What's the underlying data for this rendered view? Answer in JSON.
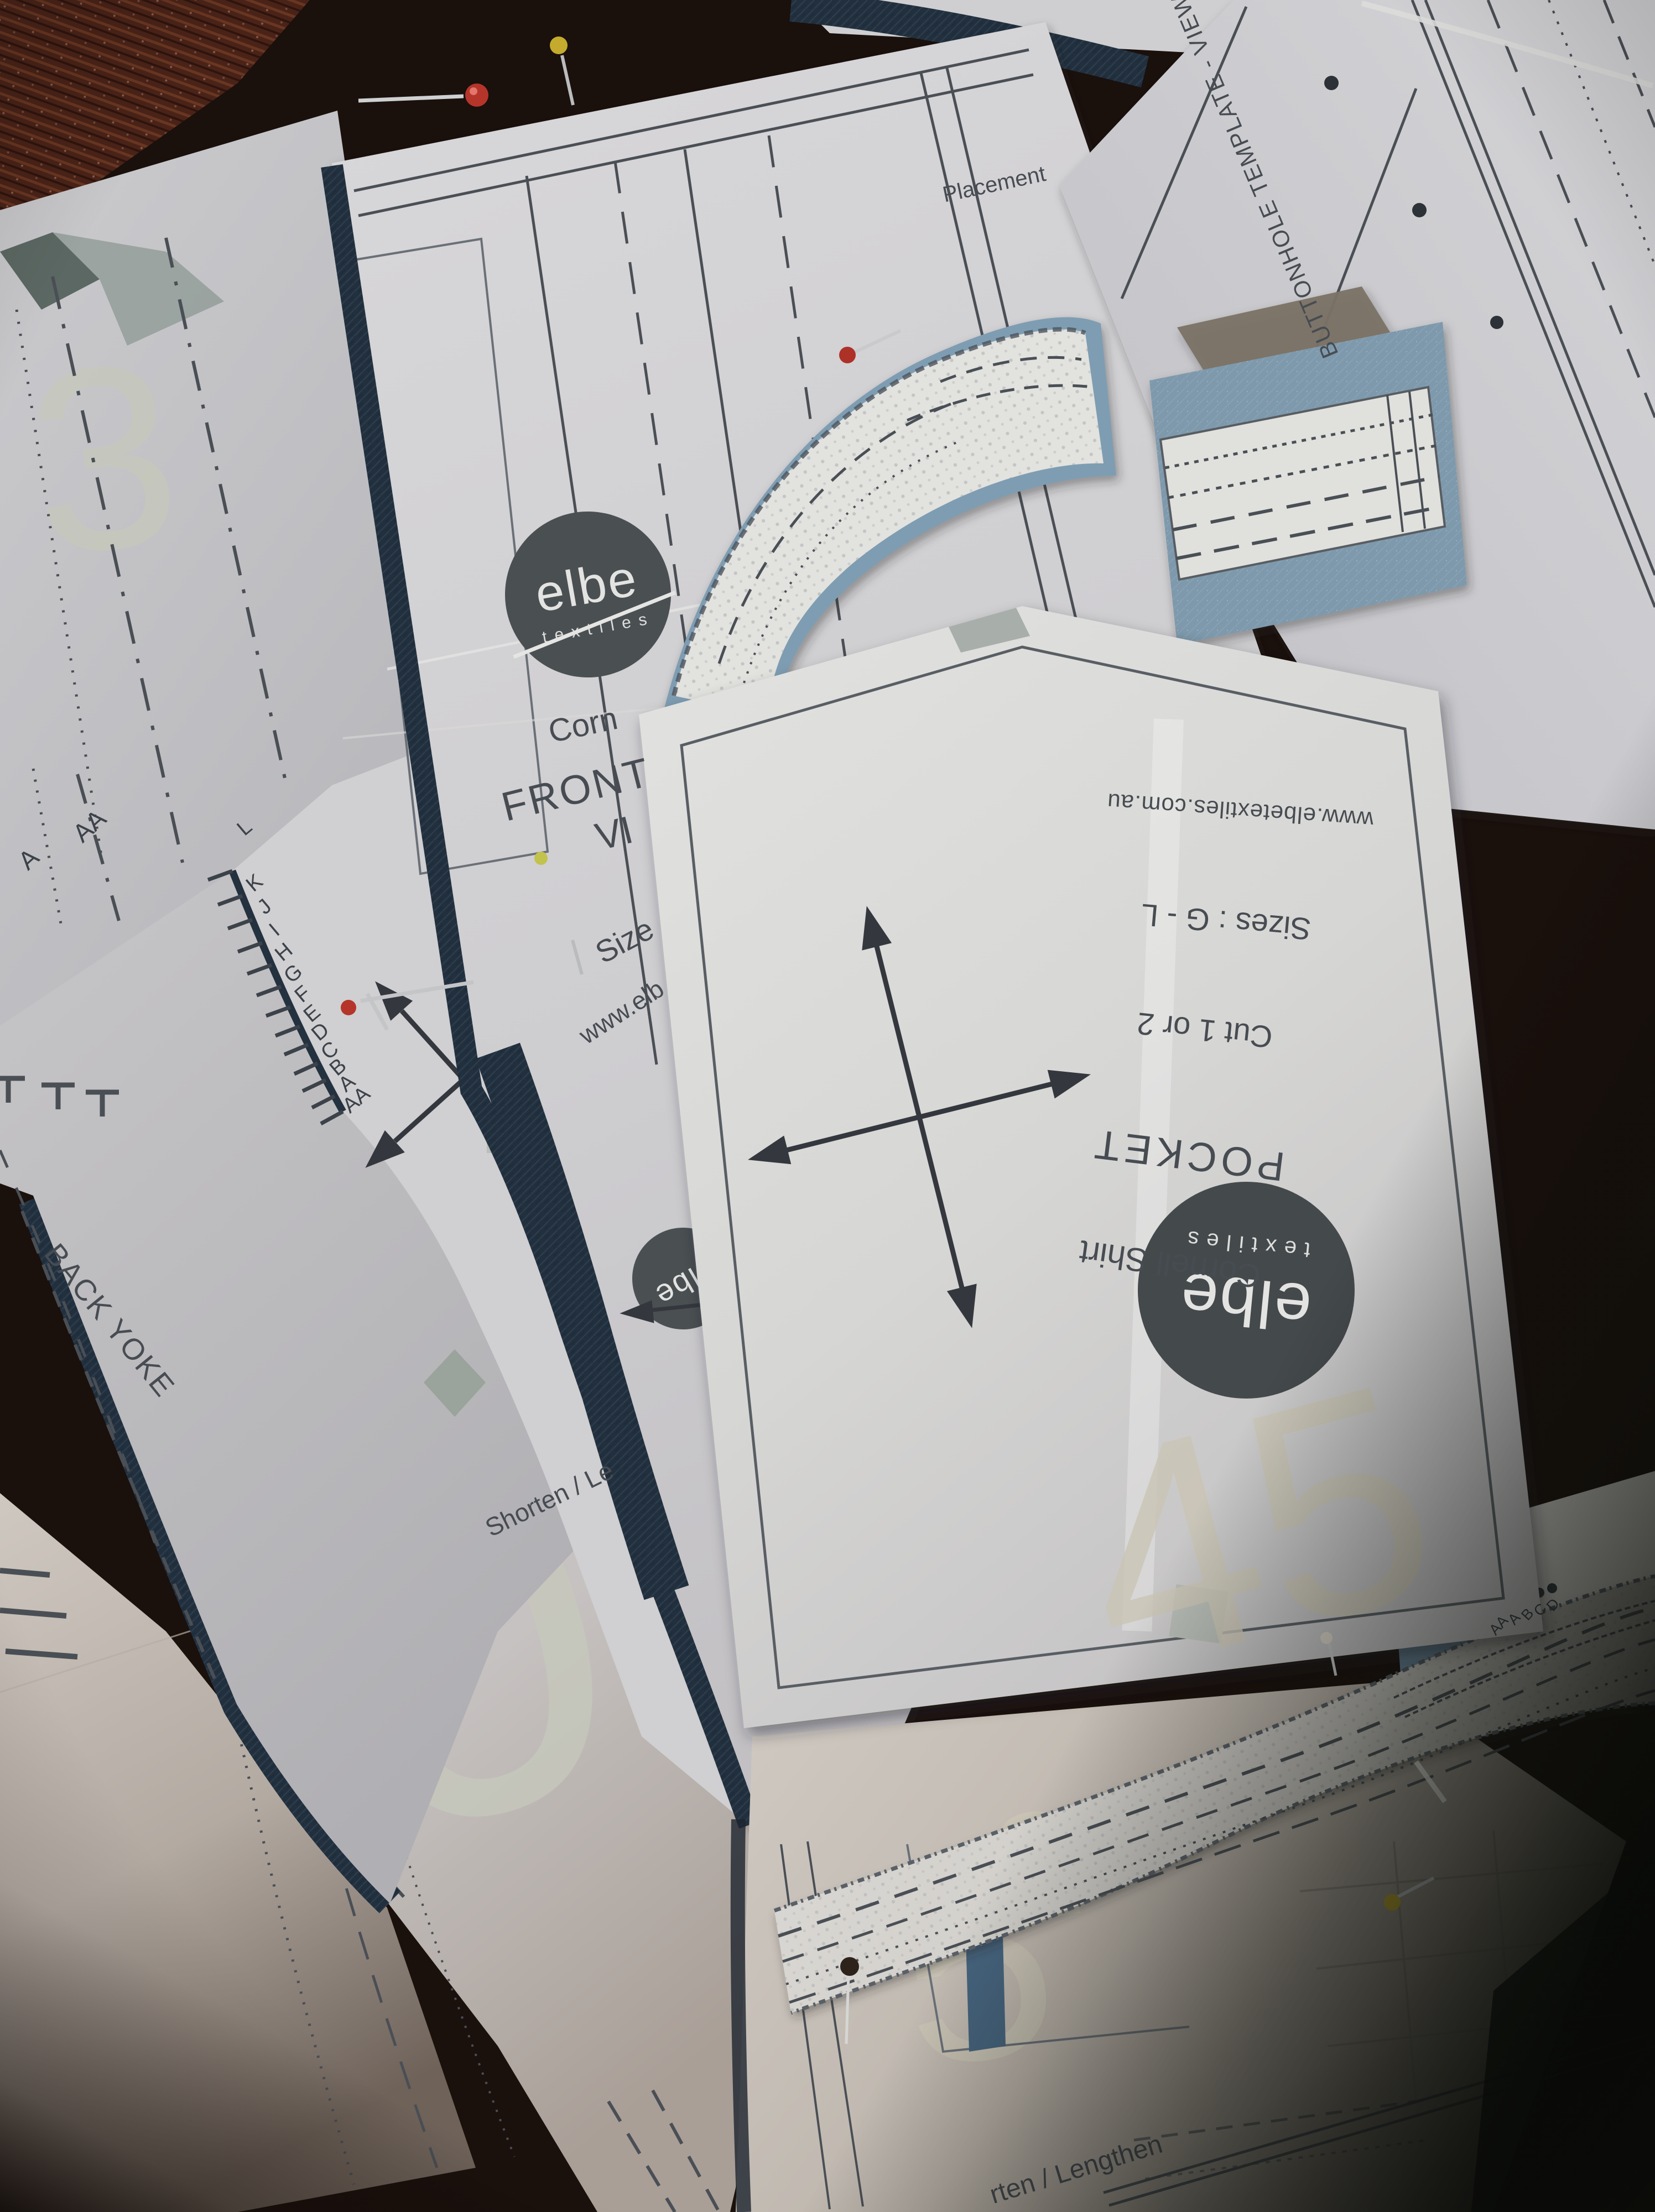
{
  "brand": {
    "name": "elbe",
    "tagline": "textiles"
  },
  "pocket_piece": {
    "website": "www.elbetextiles.com.au",
    "sizes": "Sizes : G - L",
    "cutting": "Cut 1 or 2",
    "piece_name": "POCKET",
    "pattern_name": "Cornell Shirt"
  },
  "front_piece": {
    "pattern_name_partial": "Corn",
    "piece_name": "FRONT",
    "view_partial": "VI",
    "sizes_partial": "Size",
    "website_partial": "www.elb",
    "placement_label": "Placement",
    "shorten_lengthen_partial": "Shorten / Le"
  },
  "back_yoke_piece": {
    "piece_name": "BACK YOKE"
  },
  "buttonhole_piece": {
    "title": "BUTTONHOLE TEMPLATE - VIEW A"
  },
  "bottom_piece": {
    "shorten_lengthen_partial": "rten / Lengthen"
  },
  "size_grading": {
    "curve_letters": [
      "L",
      "K",
      "J",
      "I",
      "H",
      "G",
      "F",
      "E",
      "D",
      "C",
      "B",
      "A",
      "AA"
    ],
    "corner_letter_a": "A",
    "corner_letter_aa": "AA",
    "buttonhole_letters": [
      "AA",
      "A",
      "B",
      "C",
      "D"
    ]
  },
  "sheet_numbers": {
    "top_left_sheet": "3",
    "left_sheet": "20",
    "right_sheet": "45",
    "bottom_sheet": "5",
    "bottom_sheet_partial": "2"
  },
  "colors": {
    "paper": "#d8d7d6",
    "print_ink": "#474c52",
    "watermark_gray": "#c6c8bc",
    "denim_navy": "#22303e",
    "chambray_blue": "#7e99ac",
    "logo_circle_gray": "#4a4f52",
    "pin_red": "#b23529",
    "pin_yellow": "#c4ab2d"
  }
}
